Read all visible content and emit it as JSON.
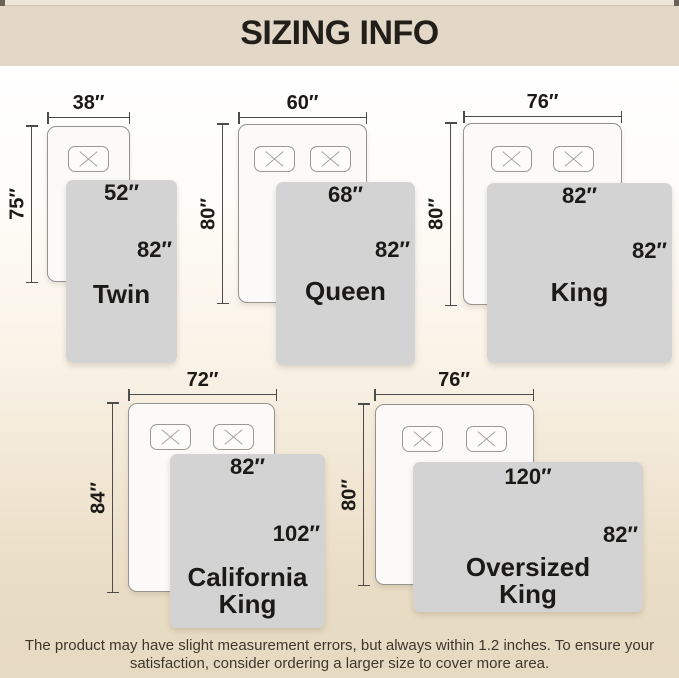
{
  "header": {
    "title": "SIZING INFO"
  },
  "diagrams": [
    {
      "id": "twin",
      "name_lines": [
        "Twin"
      ],
      "bed_width": "38″",
      "bed_length": "75″",
      "cover_width": "52″",
      "cover_length": "82″"
    },
    {
      "id": "queen",
      "name_lines": [
        "Queen"
      ],
      "bed_width": "60″",
      "bed_length": "80″",
      "cover_width": "68″",
      "cover_length": "82″"
    },
    {
      "id": "king",
      "name_lines": [
        "King"
      ],
      "bed_width": "76″",
      "bed_length": "80″",
      "cover_width": "82″",
      "cover_length": "82″"
    },
    {
      "id": "california-king",
      "name_lines": [
        "California",
        "King"
      ],
      "bed_width": "72″",
      "bed_length": "84″",
      "cover_width": "82″",
      "cover_length": "102″"
    },
    {
      "id": "oversized-king",
      "name_lines": [
        "Oversized",
        "King"
      ],
      "bed_width": "76″",
      "bed_length": "80″",
      "cover_width": "120″",
      "cover_length": "82″"
    }
  ],
  "footer": {
    "line1": "The product may have slight measurement errors, but always within 1.2 inches. To ensure your",
    "line2": "satisfaction, consider ordering a larger size to cover more area."
  },
  "colors": {
    "header_bg": "#e3d8c8",
    "cover_fill": "#d3d3d4",
    "bed_fill": "#fbfaf8",
    "text": "#1c1a17",
    "measure_line": "#4c4c4c",
    "page_bottom_bg": "#e7dac2"
  }
}
